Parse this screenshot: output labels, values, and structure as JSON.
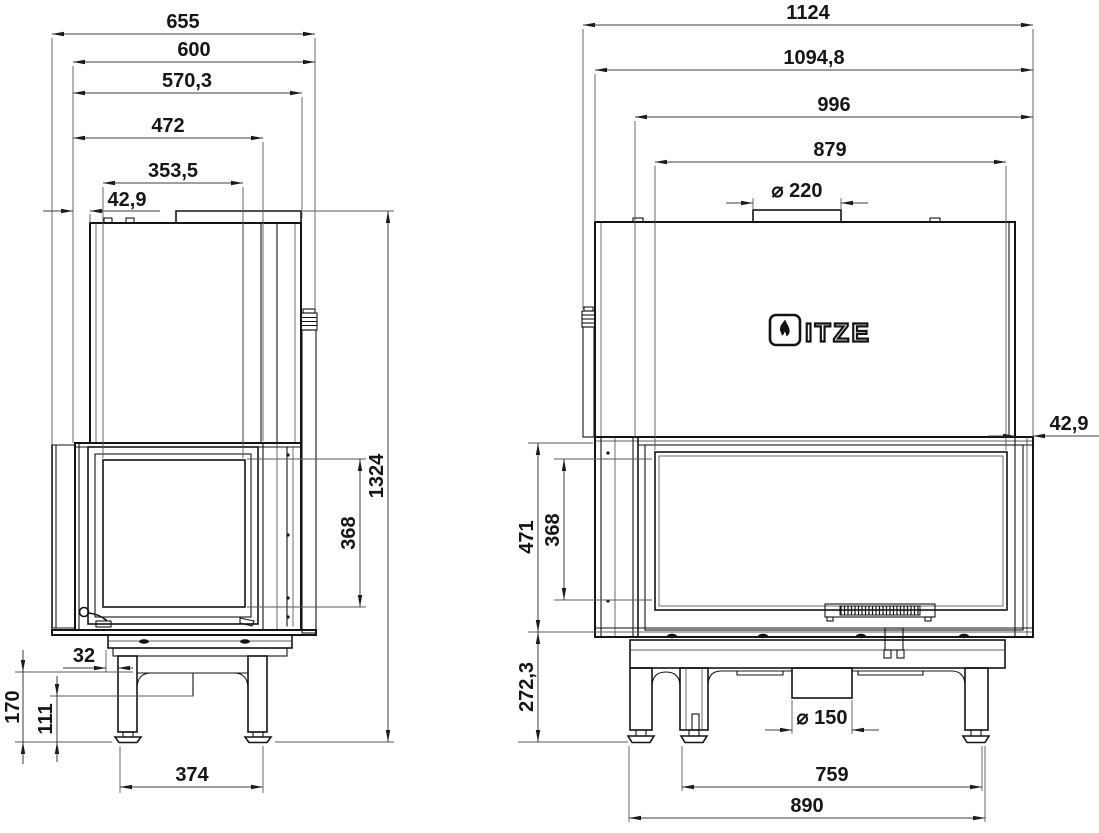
{
  "drawing": {
    "background": "#ffffff",
    "line_color": "#141414",
    "dim_color": "#3d3d3d",
    "brand": {
      "logo_text": "HITZE",
      "logo_letters": "ITZE",
      "logo_symbol": "flame-in-rounded-square"
    },
    "side_view": {
      "label": "side-view",
      "dimensions": {
        "overall_depth": "655",
        "body_depth": "600",
        "depth_570_3": "570,3",
        "depth_472": "472",
        "glass_depth": "353,5",
        "door_offset": "42,9",
        "overall_height": "1324",
        "glass_height": "368",
        "leg_offset": "32",
        "base_height": "170",
        "leg_height": "111",
        "feet_spacing": "374"
      }
    },
    "front_view": {
      "label": "front-view",
      "dimensions": {
        "overall_width": "1124",
        "body_width": "1094,8",
        "inner_width": "996",
        "glass_width": "879",
        "flue_diameter": "⌀ 220",
        "door_offset": "42,9",
        "firebox_height": "471",
        "glass_height": "368",
        "base_height": "272,3",
        "air_inlet_diameter": "⌀ 150",
        "feet_spacing_inner": "759",
        "feet_spacing_outer": "890"
      }
    }
  }
}
